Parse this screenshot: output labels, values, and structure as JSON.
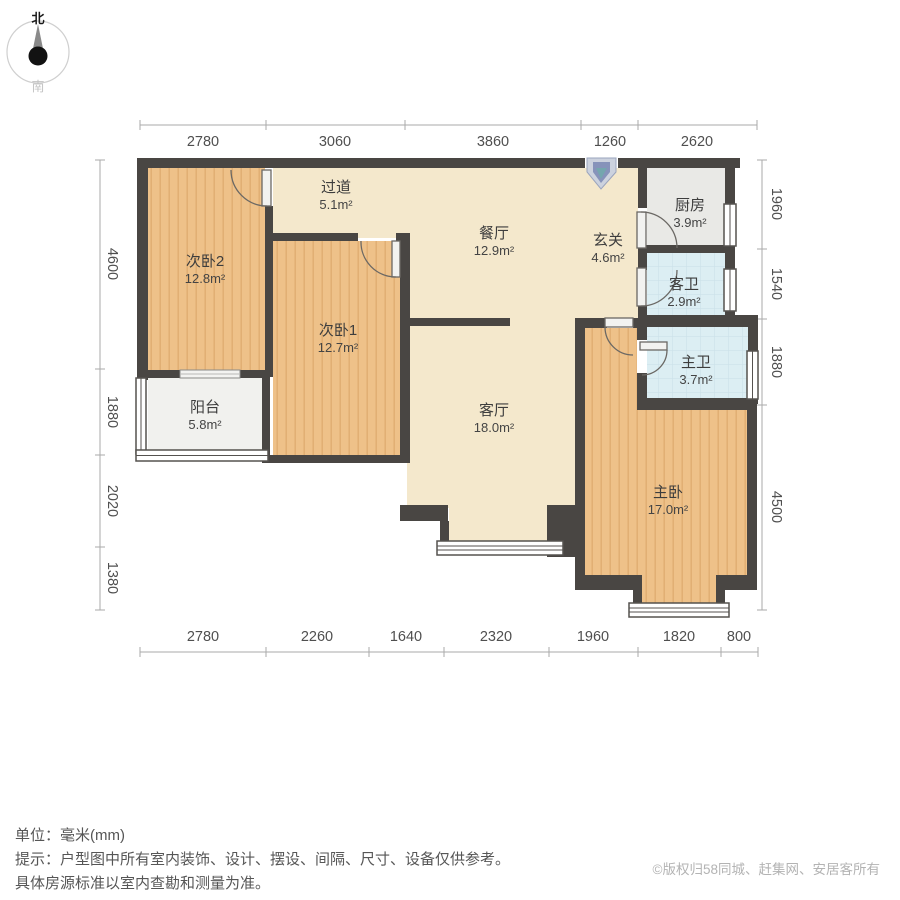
{
  "compass": {
    "north": "北",
    "south": "南"
  },
  "rooms": [
    {
      "id": "bedroom2",
      "name": "次卧2",
      "area": "12.8m²"
    },
    {
      "id": "hallway",
      "name": "过道",
      "area": "5.1m²"
    },
    {
      "id": "dining",
      "name": "餐厅",
      "area": "12.9m²"
    },
    {
      "id": "entry",
      "name": "玄关",
      "area": "4.6m²"
    },
    {
      "id": "kitchen",
      "name": "厨房",
      "area": "3.9m²"
    },
    {
      "id": "guest-bath",
      "name": "客卫",
      "area": "2.9m²"
    },
    {
      "id": "bedroom1",
      "name": "次卧1",
      "area": "12.7m²"
    },
    {
      "id": "master-bath",
      "name": "主卫",
      "area": "3.7m²"
    },
    {
      "id": "balcony",
      "name": "阳台",
      "area": "5.8m²"
    },
    {
      "id": "living",
      "name": "客厅",
      "area": "18.0m²"
    },
    {
      "id": "master-bedroom",
      "name": "主卧",
      "area": "17.0m²"
    }
  ],
  "dimensions": {
    "top": [
      "2780",
      "3060",
      "3860",
      "1260",
      "2620"
    ],
    "bottom": [
      "2780",
      "2260",
      "1640",
      "2320",
      "1960",
      "1820",
      "800"
    ],
    "left": [
      "4600",
      "1880",
      "2020",
      "1380"
    ],
    "right": [
      "1960",
      "1540",
      "1880",
      "4500"
    ]
  },
  "footer": {
    "unit_label": "单位：毫米(mm)",
    "tip_line1": "提示：户型图中所有室内装饰、设计、摆设、间隔、尺寸、设备仅供参考。",
    "tip_line2": "具体房源标准以室内查勘和测量为准。",
    "copyright": "©版权归58同城、赶集网、安居客所有"
  },
  "colors": {
    "wall": "#494643",
    "wood_floor": "#eec189",
    "beige_floor": "#f4e8cc",
    "kitchen_floor": "#e9e9e6",
    "bath_floor": "#dceef3",
    "balcony_floor": "#f1f1ee",
    "dim_line": "#aaaaaa",
    "entry_marker": "#8693ba"
  }
}
